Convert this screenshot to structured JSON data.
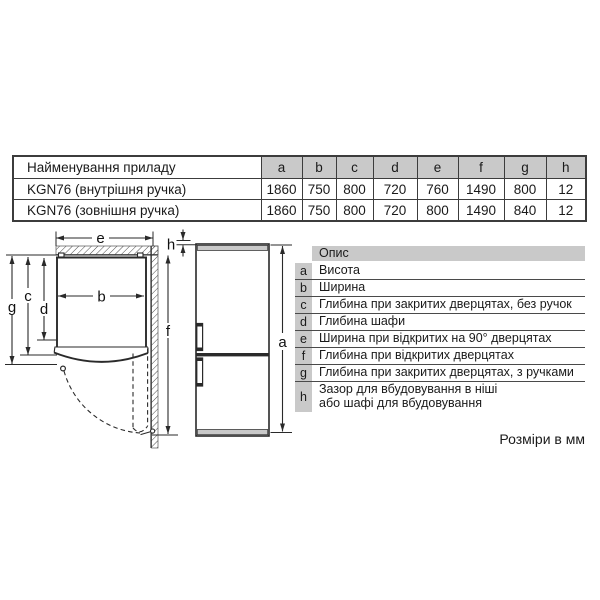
{
  "table": {
    "name_header": "Найменування приладу",
    "columns": [
      "a",
      "b",
      "c",
      "d",
      "e",
      "f",
      "g",
      "h"
    ],
    "rows": [
      {
        "name": "KGN76 (внутрішня ручка)",
        "values": [
          "1860",
          "750",
          "800",
          "720",
          "760",
          "1490",
          "800",
          "12"
        ]
      },
      {
        "name": "KGN76 (зовнішня ручка)",
        "values": [
          "1860",
          "750",
          "800",
          "720",
          "800",
          "1490",
          "840",
          "12"
        ]
      }
    ]
  },
  "legend": {
    "header": "Опис",
    "rows": [
      {
        "key": "a",
        "desc": "Висота"
      },
      {
        "key": "b",
        "desc": "Ширина"
      },
      {
        "key": "c",
        "desc": "Глибина при закритих дверцятах, без ручок"
      },
      {
        "key": "d",
        "desc": "Глибина шафи"
      },
      {
        "key": "e",
        "desc": "Ширина при відкритих на 90° дверцятах"
      },
      {
        "key": "f",
        "desc": "Глибина при відкритих дверцятах"
      },
      {
        "key": "g",
        "desc": "Глибина при закритих дверцятах, з ручками"
      },
      {
        "key": "h",
        "desc": "Зазор для вбудовування в ніші\nабо шафі для вбудовування"
      }
    ]
  },
  "diagram": {
    "labels": {
      "a": "a",
      "b": "b",
      "c": "c",
      "d": "d",
      "e": "e",
      "f": "f",
      "g": "g",
      "h": "h"
    }
  },
  "footer": {
    "text": "Розміри в мм"
  },
  "colors": {
    "header_gray": "#c9c9c9",
    "line": "#2a2a2a"
  }
}
